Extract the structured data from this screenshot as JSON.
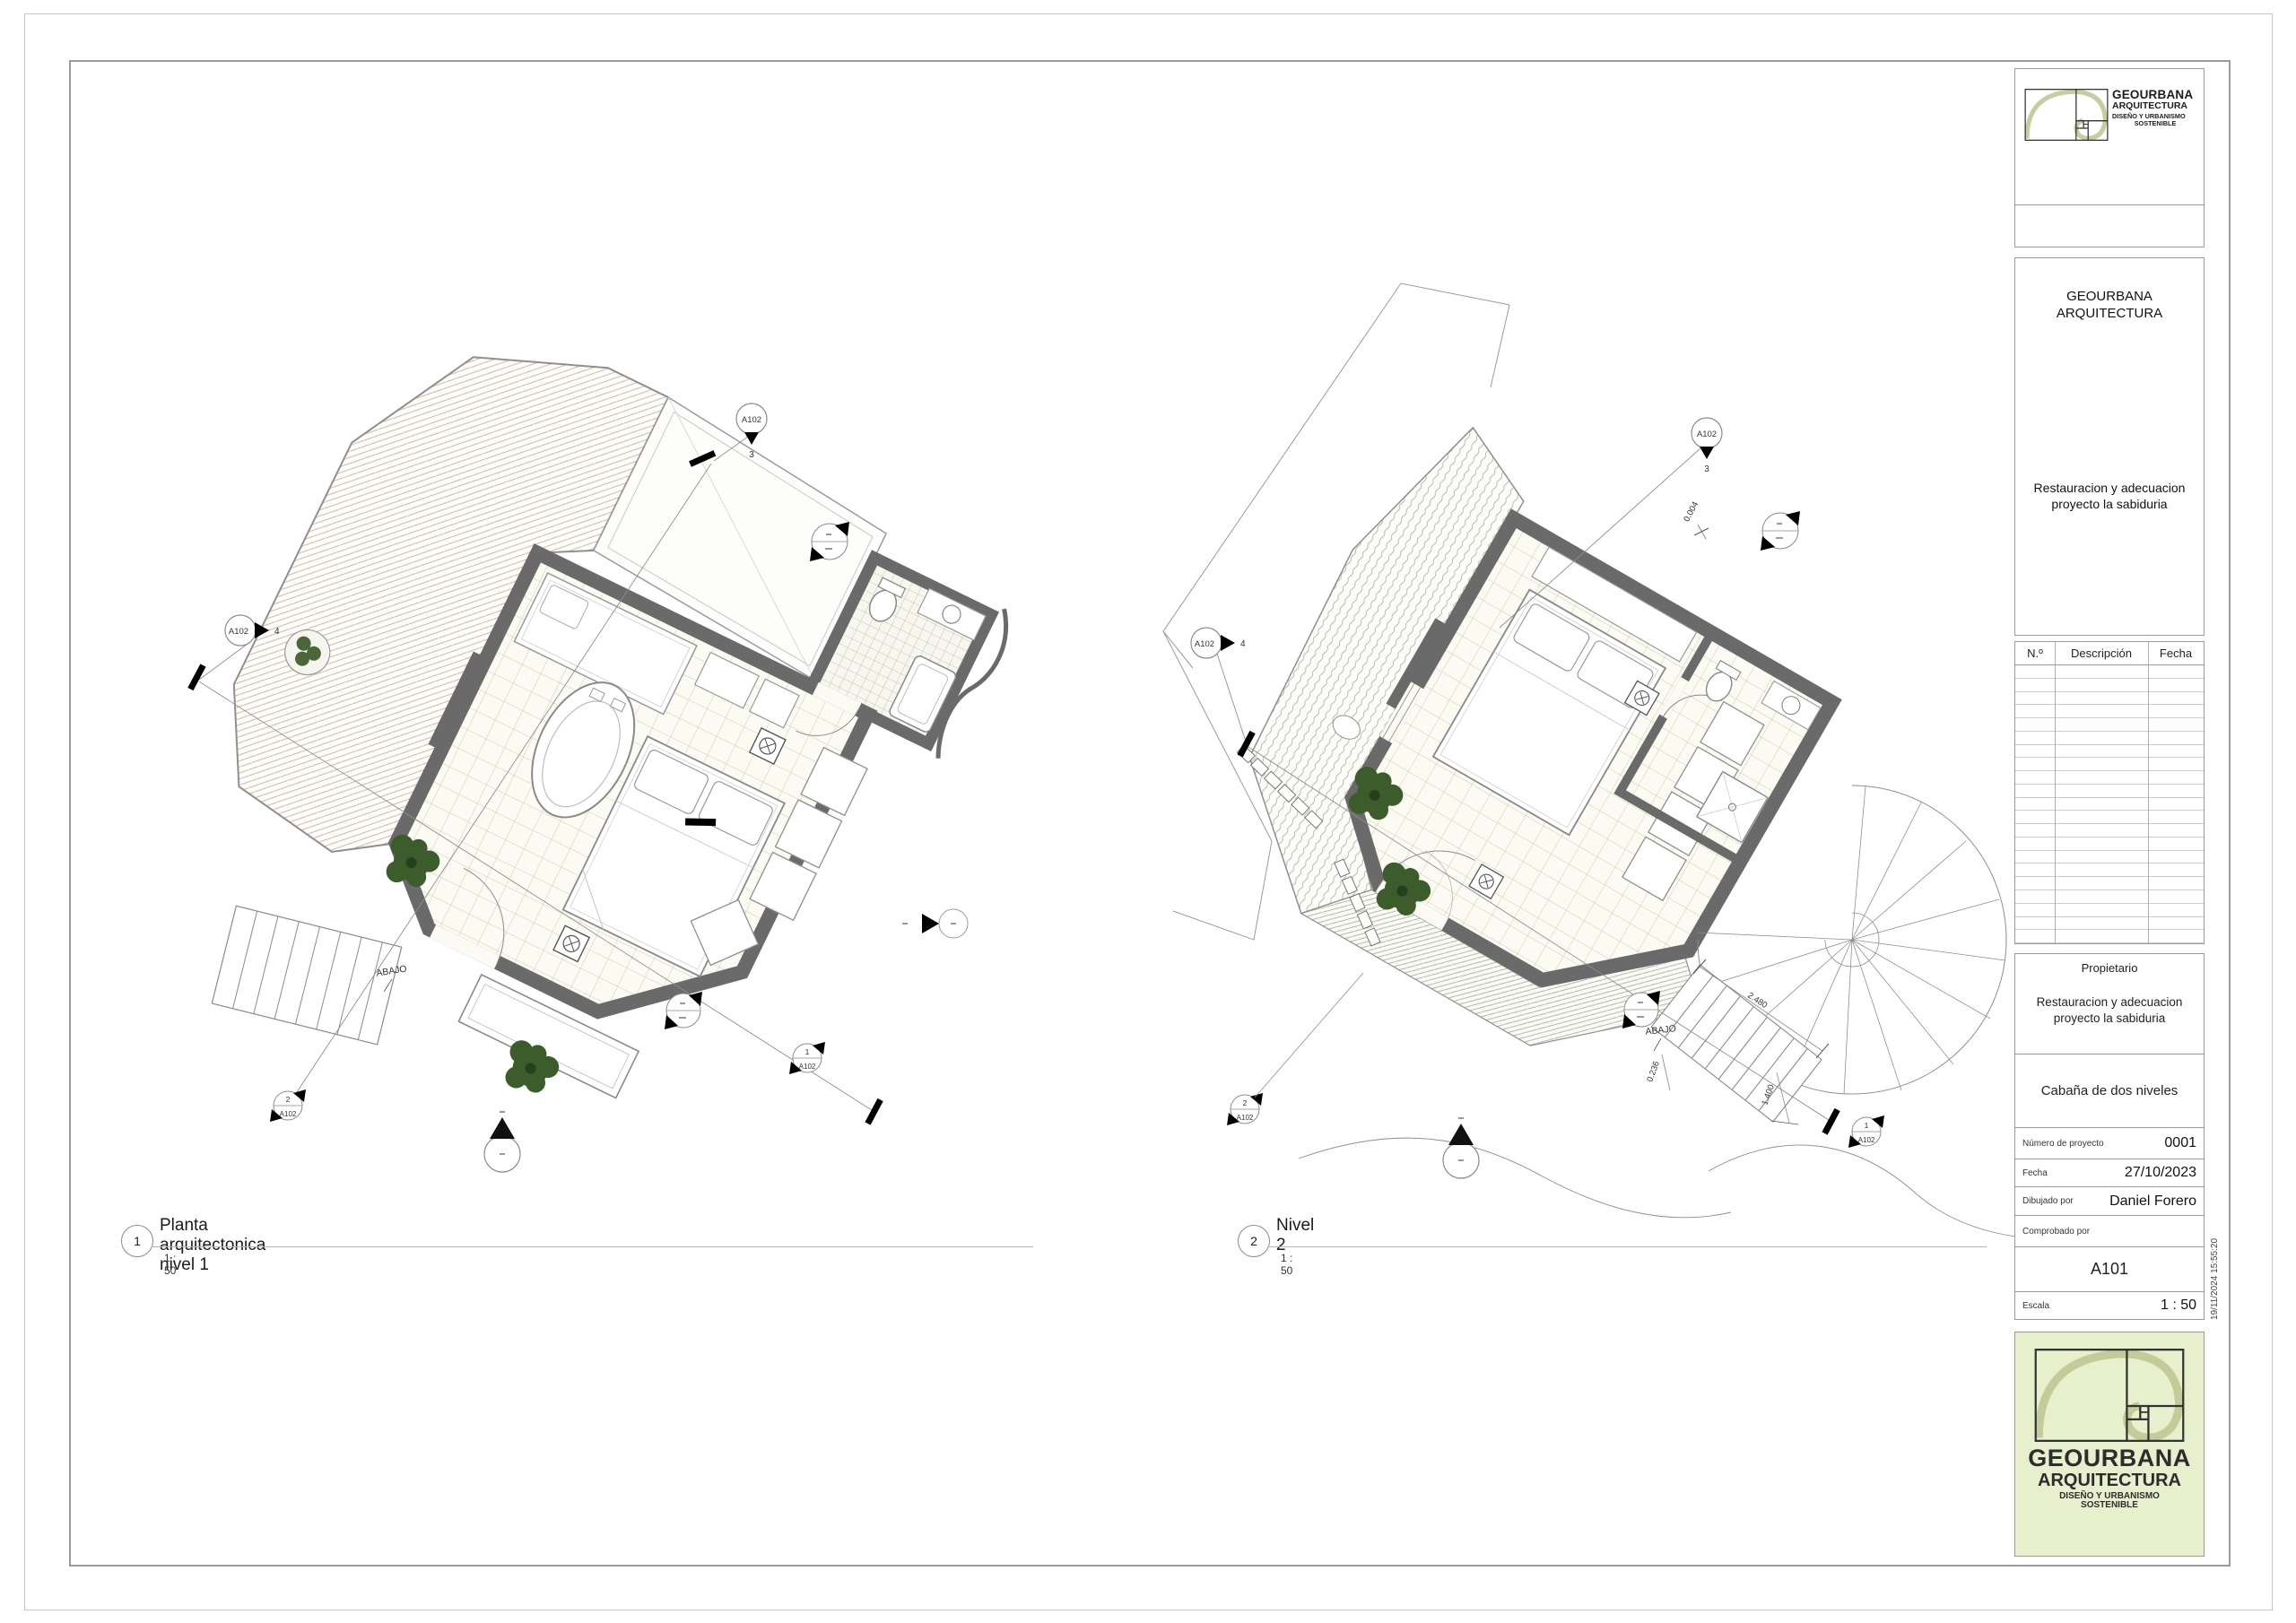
{
  "page": {
    "stamp": "19/11/2024 15:55:20"
  },
  "brand": {
    "name": "GEOURBANA",
    "field": "ARQUITECTURA",
    "tag1": "DISEÑO Y URBANISMO",
    "tag2": "SOSTENIBLE"
  },
  "titleblock": {
    "company_line1": "GEOURBANA",
    "company_line2": "ARQUITECTURA",
    "project_desc_line1": "Restauracion y adecuacion",
    "project_desc_line2": "proyecto la sabiduria",
    "rev_headers": {
      "num": "N.º",
      "desc": "Descripción",
      "date": "Fecha"
    },
    "rev_row_count": 21,
    "owner_title": "Propietario",
    "owner_desc_line1": "Restauracion y adecuacion",
    "owner_desc_line2": "proyecto la sabiduria",
    "project_name": "Cabaña de dos niveles",
    "fields": {
      "project_number_label": "Número de proyecto",
      "project_number": "0001",
      "date_label": "Fecha",
      "date": "27/10/2023",
      "drawn_by_label": "Dibujado por",
      "drawn_by": "Daniel Forero",
      "checked_by_label": "Comprobado por",
      "checked_by": "",
      "sheet_number": "A101",
      "scale_label": "Escala",
      "scale": "1 : 50"
    }
  },
  "views": {
    "v1": {
      "number": "1",
      "title": "Planta arquitectonica nivel 1",
      "scale": "1 : 50"
    },
    "v2": {
      "number": "2",
      "title": "Nivel 2",
      "scale": "1 : 50"
    }
  },
  "annotations": {
    "p1": {
      "abajo": "ABAJO",
      "top_sheet": "A102",
      "top_num": "3",
      "left_sheet": "A102",
      "left_num": "4",
      "sec1_num": "1",
      "sec1_sheet": "A102",
      "sec2_num": "2",
      "sec2_sheet": "A102"
    },
    "p2": {
      "abajo": "ABAJO",
      "top_sheet": "A102",
      "top_num": "3",
      "left_sheet": "A102",
      "left_num": "4",
      "sec1_num": "1",
      "sec1_sheet": "A102",
      "sec2_num": "2",
      "sec2_sheet": "A102",
      "dim_a": "0.004",
      "dim_b": "2.480",
      "dim_c": "0.236",
      "dim_d": "1.400"
    }
  },
  "colors": {
    "wall": "#6a6a6a",
    "accent_green": "#e8efcd",
    "plant": "#3c5c2c"
  }
}
